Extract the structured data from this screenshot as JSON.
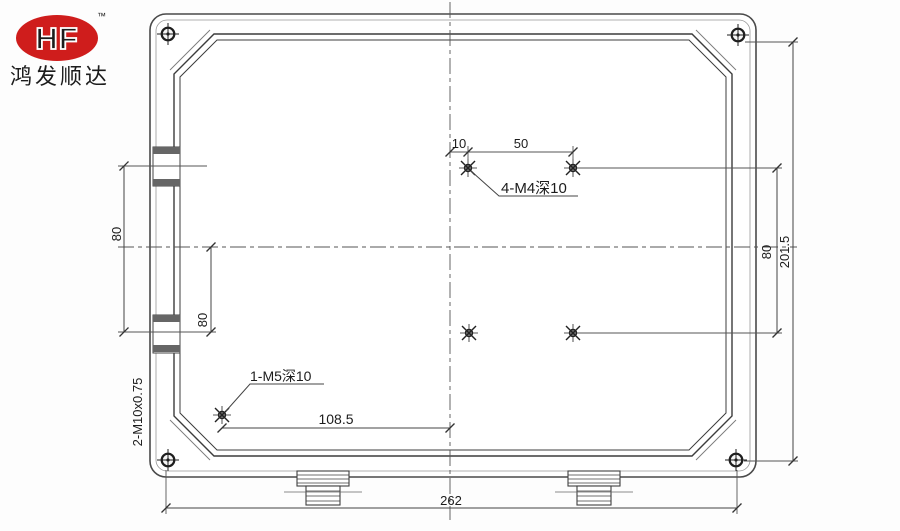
{
  "logo": {
    "brand": "HF",
    "trademark": "™",
    "company": "鸿发顺达",
    "accent_color": "#cf1d1c"
  },
  "dims": {
    "top_offset": "10",
    "top_pitch": "50",
    "left_upper": "80",
    "left_lower": "80",
    "right_holes": "80",
    "right_overall": "201.5",
    "m5_offset": "108.5",
    "bottom_overall": "262"
  },
  "notes": {
    "top_holes": "4-M4深10",
    "m5": "1-M5深10",
    "glands": "2-M10x0.75"
  },
  "style": {
    "line_color": "#3f3f3f",
    "dim_color": "#555555"
  }
}
